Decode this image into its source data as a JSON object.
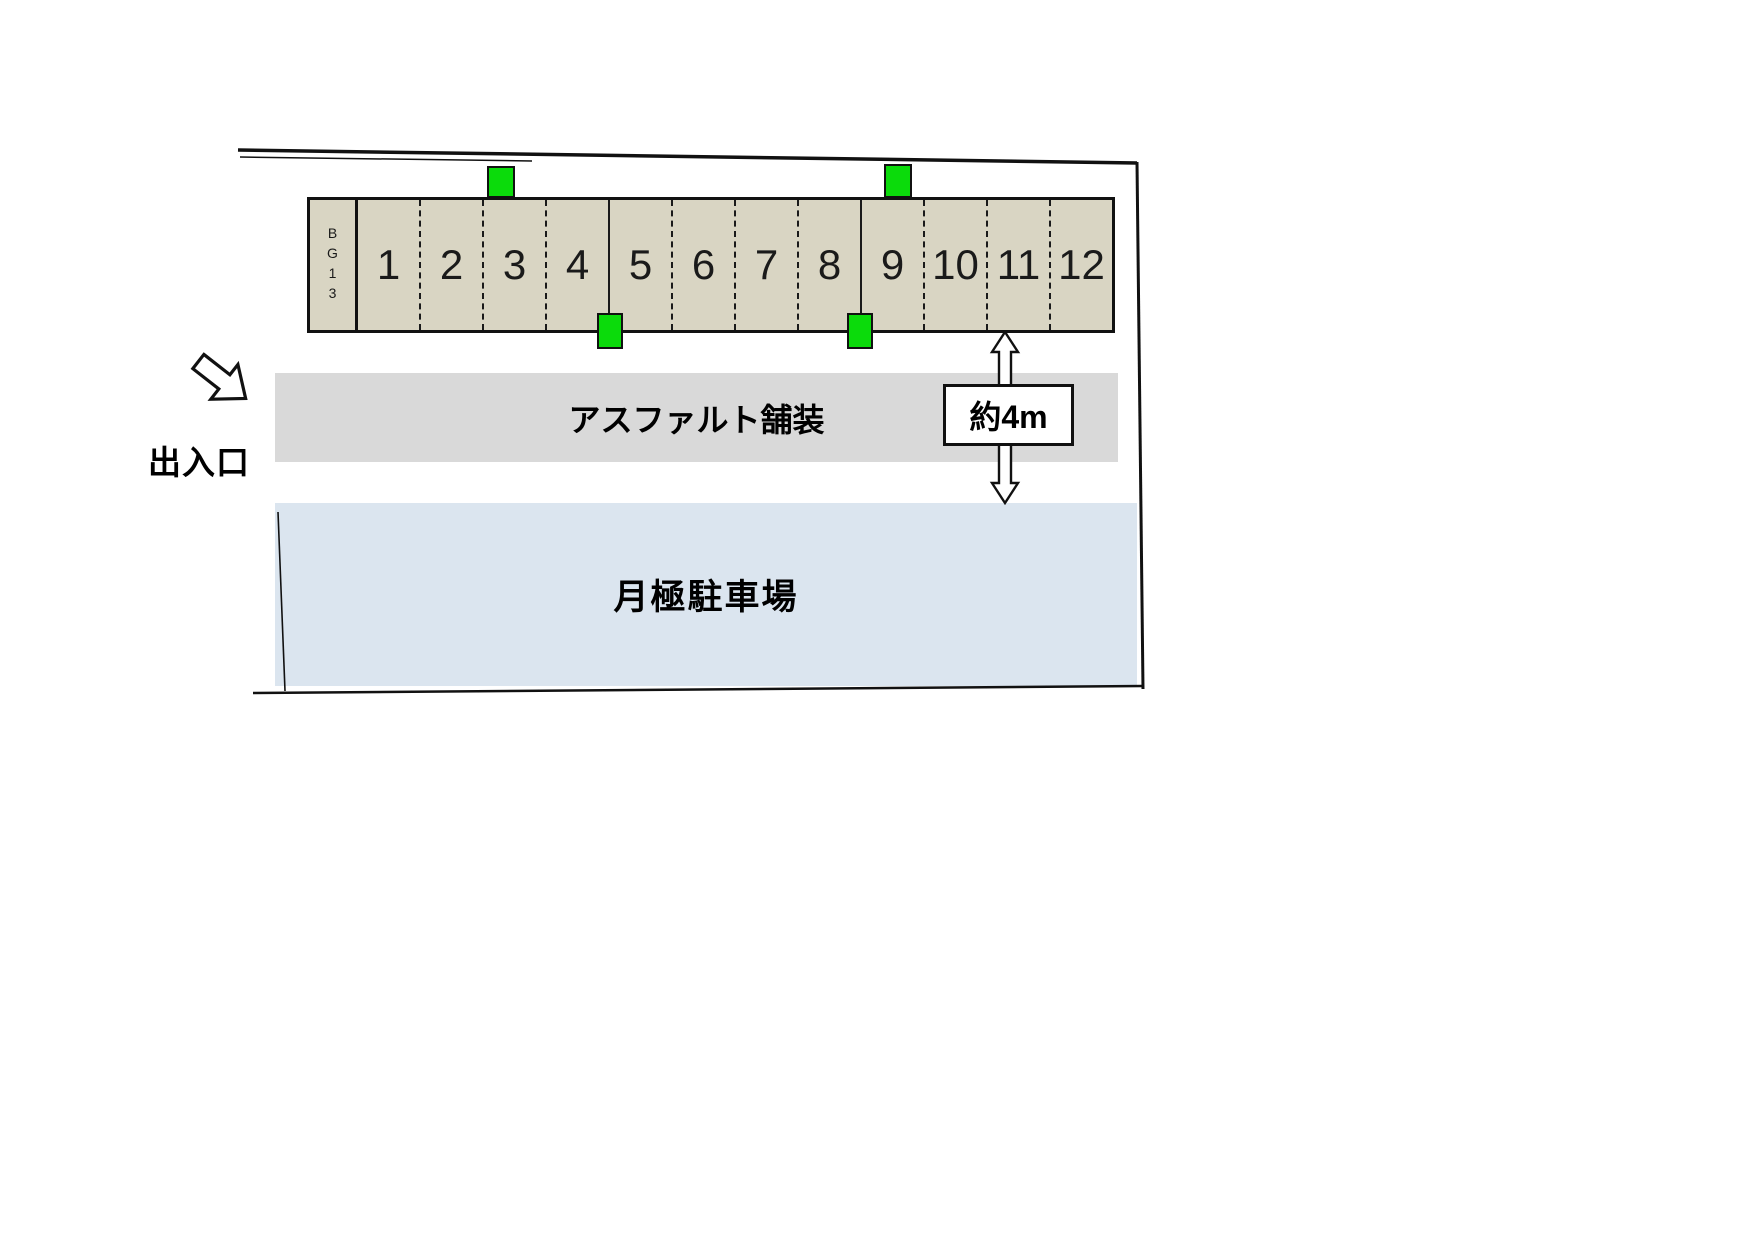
{
  "site": {
    "parking_row": {
      "label": "BG13",
      "spaces": [
        {
          "label": "1",
          "divider": "none"
        },
        {
          "label": "2",
          "divider": "dashed"
        },
        {
          "label": "3",
          "divider": "dashed"
        },
        {
          "label": "4",
          "divider": "dashed"
        },
        {
          "label": "5",
          "divider": "solid"
        },
        {
          "label": "6",
          "divider": "dashed"
        },
        {
          "label": "7",
          "divider": "dashed"
        },
        {
          "label": "8",
          "divider": "dashed"
        },
        {
          "label": "9",
          "divider": "solid"
        },
        {
          "label": "10",
          "divider": "dashed"
        },
        {
          "label": "11",
          "divider": "dashed"
        },
        {
          "label": "12",
          "divider": "dashed"
        }
      ]
    },
    "asphalt_strip": {
      "label": "アスファルト舗装"
    },
    "monthly_lot": {
      "label": "月極駐車場"
    },
    "entrance": {
      "label": "出入口"
    },
    "dimension": {
      "label": "約4m"
    },
    "markers": {
      "count": 4,
      "shape": "green-square"
    }
  },
  "colors": {
    "space-fill": "#d9d5c3",
    "marker-green": "#0bdb0b",
    "asphalt-gray": "#d9d9d9",
    "lot-blue": "#dbe5ef",
    "line-black": "#111111"
  }
}
